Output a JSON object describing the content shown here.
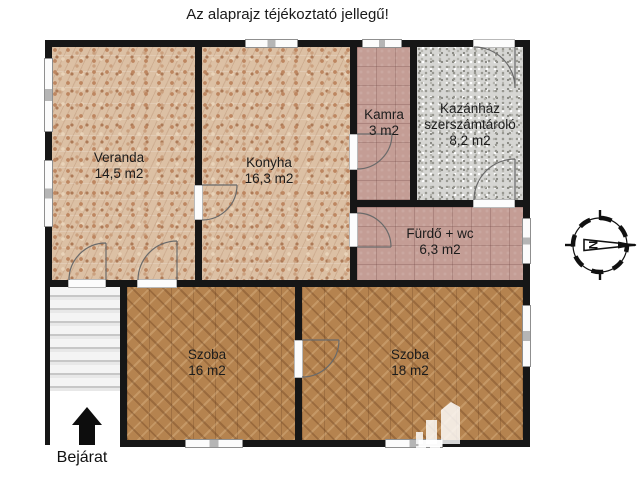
{
  "title": "Az alaprajz téjékoztató jellegű!",
  "rooms": [
    {
      "id": "veranda",
      "name": "Veranda",
      "area": "14,5 m2",
      "floor": "mosaic-tile"
    },
    {
      "id": "konyha",
      "name": "Konyha",
      "area": "16,3 m2",
      "floor": "mosaic-tile"
    },
    {
      "id": "kamra",
      "name": "Kamra",
      "area": "3 m2",
      "floor": "mauve-tile"
    },
    {
      "id": "kazanhaz",
      "name": "Kazánház szerszámtároló",
      "area": "8,2 m2",
      "floor": "concrete"
    },
    {
      "id": "furdo",
      "name": "Fürdő + wc",
      "area": "6,3 m2",
      "floor": "mauve-tile"
    },
    {
      "id": "szoba16",
      "name": "Szoba",
      "area": "16 m2",
      "floor": "parquet"
    },
    {
      "id": "szoba18",
      "name": "Szoba",
      "area": "18 m2",
      "floor": "parquet"
    }
  ],
  "entrance": {
    "label": "Bejárat"
  },
  "compass": {
    "letter": "N"
  },
  "watermark": {
    "brand": "VÁR",
    "sub": "INGATLAN"
  },
  "colors": {
    "wall": "#161616",
    "mosaic_floor": "#dcc0a4",
    "mauve_floor": "#c49d95",
    "concrete_floor": "#d6d6d3",
    "parquet_floor": "#b5834f",
    "watermark": "rgba(255,255,255,0.82)"
  }
}
